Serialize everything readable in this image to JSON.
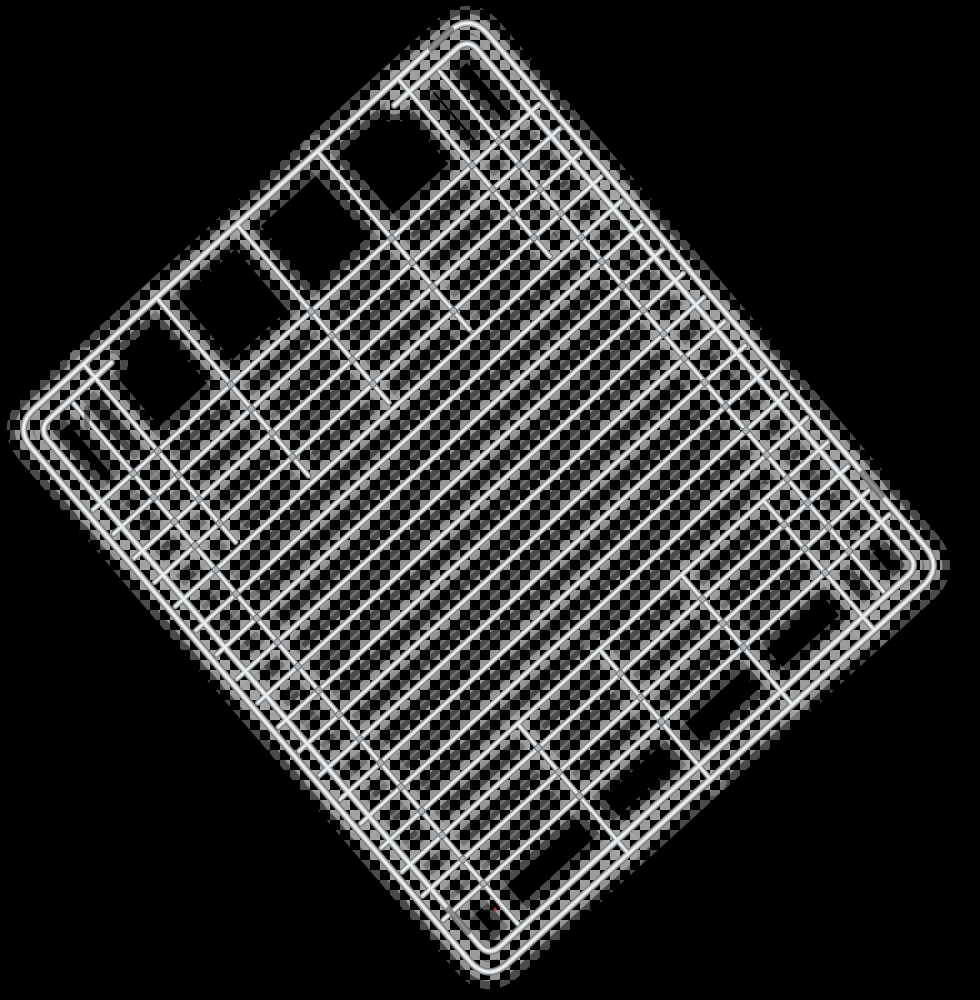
{
  "scene": {
    "description": "Chromed metal wire rack (oven / grill shelf) photographed rotated diagonally on a black background, with light-gray checkerboard transparency artifacts hugging every wire",
    "background_color": "#000000",
    "canvas": {
      "width": 980,
      "height": 1000
    },
    "checker_artifact": {
      "square_px": 10,
      "light_color": "#a6a6a6",
      "bands": [
        [
          34,
          0.45
        ],
        [
          18,
          0.8
        ],
        [
          8,
          1.0
        ]
      ]
    },
    "red_speck": {
      "x": 495,
      "y": 909,
      "r": 1.6,
      "color": "#b5271f"
    }
  },
  "rack": {
    "transform_matrix": [
      0.654,
      0.766,
      -0.7448,
      0.6769,
      470,
      8
    ],
    "local_width": 731,
    "local_height": 619,
    "outer_frame": {
      "inset": 3.5,
      "radius": 28
    },
    "inner_frame": {
      "inset": 21,
      "radius": 15,
      "left_gap_top": 120,
      "left_gap_bottom": 500
    },
    "rods": {
      "y": [
        64,
        555
      ],
      "x1": 26,
      "x2": 705
    },
    "bars": {
      "count": 18,
      "x0": 117,
      "dx": 31.5,
      "y1": 10,
      "y2": 609
    },
    "fingers": {
      "left": {
        "x1": 4,
        "x2": 236,
        "y": [
          100,
          208,
          316,
          424,
          522
        ]
      },
      "right": {
        "x1": 559,
        "x2": 727,
        "y": [
          96,
          206,
          316,
          426
        ]
      }
    },
    "widths": {
      "frame": [
        7.4,
        4.8,
        2.0
      ],
      "wire": [
        6.0,
        3.9,
        1.6
      ]
    },
    "metal_colors": [
      "#74787b",
      "#c3c6c8",
      "#eff1f2"
    ],
    "weld": {
      "r": 3.3,
      "fill": "#b0b3b5",
      "stroke": "#63666a",
      "stroke_width": 0.8
    },
    "smudge_color": "#3f4244",
    "smudges": [
      [
        3.5,
        28,
        3.5,
        56
      ],
      [
        604,
        3.5,
        634,
        3.5
      ],
      [
        648,
        598,
        678,
        598
      ],
      [
        38,
        548,
        52,
        560
      ]
    ]
  }
}
